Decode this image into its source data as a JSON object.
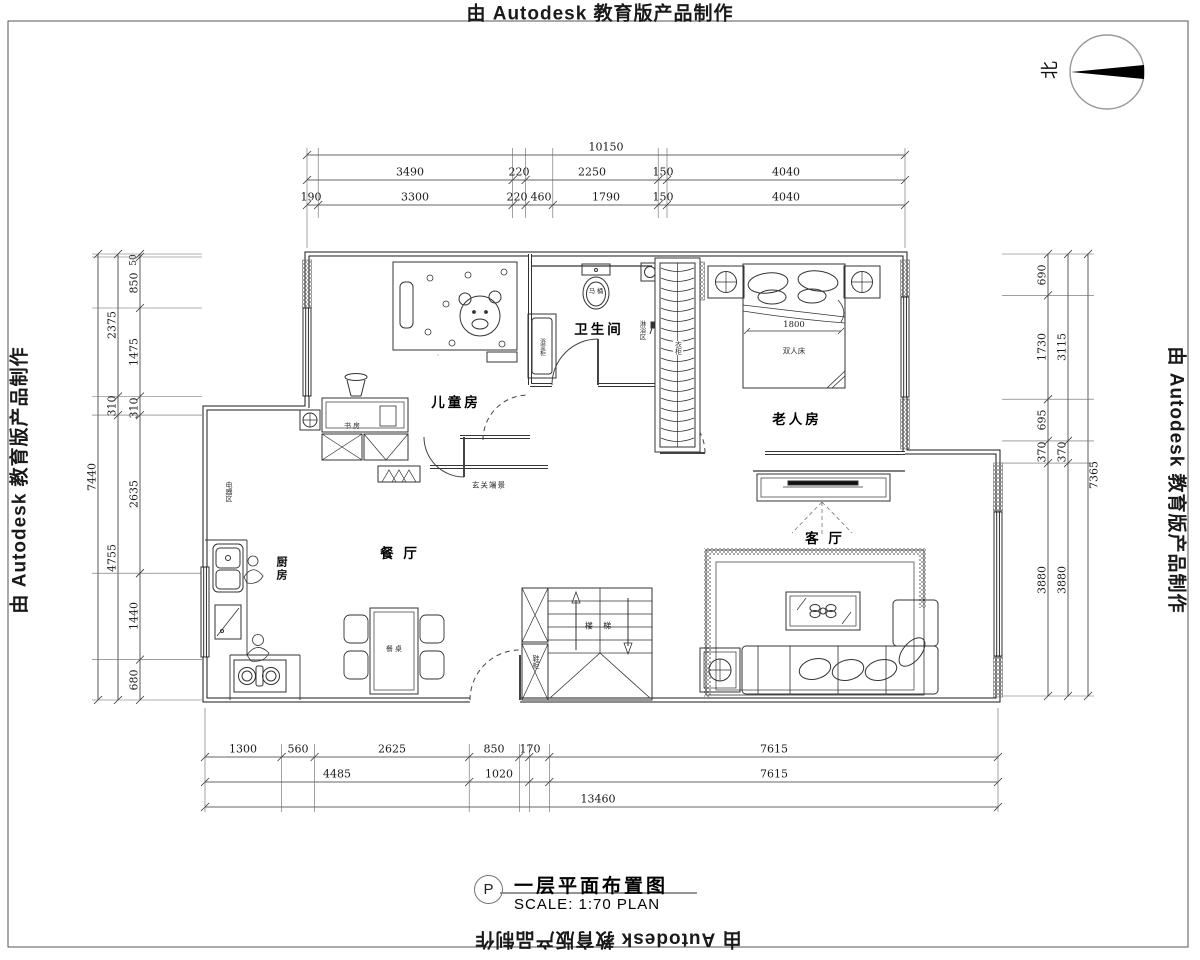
{
  "stamp": {
    "text": "由 Autodesk 教育版产品制作"
  },
  "compass": {
    "north": "北"
  },
  "title_block": {
    "tag": "P",
    "title": "一层平面布置图",
    "scale": "SCALE: 1:70 PLAN"
  },
  "labels": {
    "children_room": "儿童房",
    "bathroom": "卫生间",
    "elderly_room": "老人房",
    "dining": "餐 厅",
    "living": "客 厅",
    "kitchen": "厨房",
    "stairs": "楼 梯",
    "entry_view": "玄关端景",
    "study": "书 房",
    "appliance_area": "电器区",
    "shoe_cabinet": "鞋柜",
    "wardrobe": "衣柜",
    "shower_area": "淋浴区",
    "bath_cabinet": "浴室柜",
    "toilet": "马 桶",
    "double_bed": "双人床",
    "bed_width": "1800",
    "dining_table": "餐 桌"
  },
  "dims": {
    "top": {
      "total": "10150",
      "r2": [
        "3490",
        "220",
        "2250",
        "150",
        "4040"
      ],
      "r3": [
        "190",
        "3300",
        "220",
        "460",
        "1790",
        "150",
        "4040"
      ]
    },
    "left": {
      "total": "7440",
      "mid": [
        "2375",
        "310",
        "4755"
      ],
      "inner": [
        "50",
        "850",
        "1475",
        "310",
        "2635",
        "1440",
        "680"
      ]
    },
    "right": {
      "total": "7365",
      "mid": [
        "3115",
        "370",
        "3880"
      ],
      "inner": [
        "690",
        "1730",
        "695",
        "370",
        "3880"
      ]
    },
    "bottom": {
      "total": "13460",
      "r1": [
        "1300",
        "560",
        "2625",
        "850",
        "170",
        "7615"
      ],
      "r2": [
        "4485",
        "1020",
        "7615"
      ]
    }
  },
  "colors": {
    "line": "#1a1a1a",
    "thin": "#444",
    "hatch": "#555",
    "compass_ring": "#999"
  }
}
